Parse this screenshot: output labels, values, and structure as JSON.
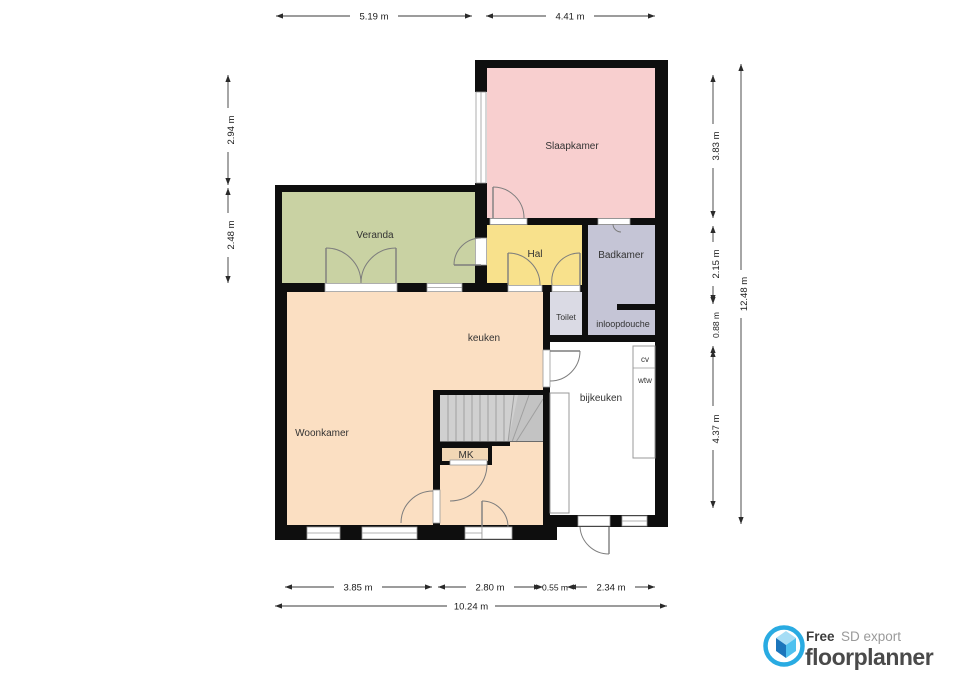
{
  "rooms": {
    "slaapkamer": "Slaapkamer",
    "veranda": "Veranda",
    "hal": "Hal",
    "badkamer": "Badkamer",
    "toilet": "Toilet",
    "inloopdouche": "inloopdouche",
    "keuken": "keuken",
    "woonkamer": "Woonkamer",
    "bijkeuken": "bijkeuken"
  },
  "fixtures": {
    "mk": "MK",
    "cv": "cv",
    "wtw": "wtw"
  },
  "dimensions": {
    "top": [
      "5.19 m",
      "4.41 m"
    ],
    "left": [
      "2.94 m",
      "2.48 m"
    ],
    "right": [
      "3.83 m",
      "2.15 m",
      "0.88 m",
      "4.37 m"
    ],
    "right_total": "12.48 m",
    "bottom": [
      "3.85 m",
      "2.80 m",
      "0.55 m",
      "2.34 m"
    ],
    "bottom_total": "10.24 m"
  },
  "footer": {
    "free_label": "Free",
    "export_label": "SD export",
    "brand": "floorplanner"
  },
  "colors": {
    "accent_blue": "#29abe2",
    "slaapkamer": "#f8cfcf",
    "veranda": "#c9d2a3",
    "hal": "#f8e18c",
    "badkamer": "#c5c5d6",
    "toilet": "#dadae4",
    "keuken_woonkamer": "#fbdfc2",
    "mk": "#f1d7b5",
    "stairs": "#d0d0d0",
    "bijkeuken": "#ffffff"
  }
}
